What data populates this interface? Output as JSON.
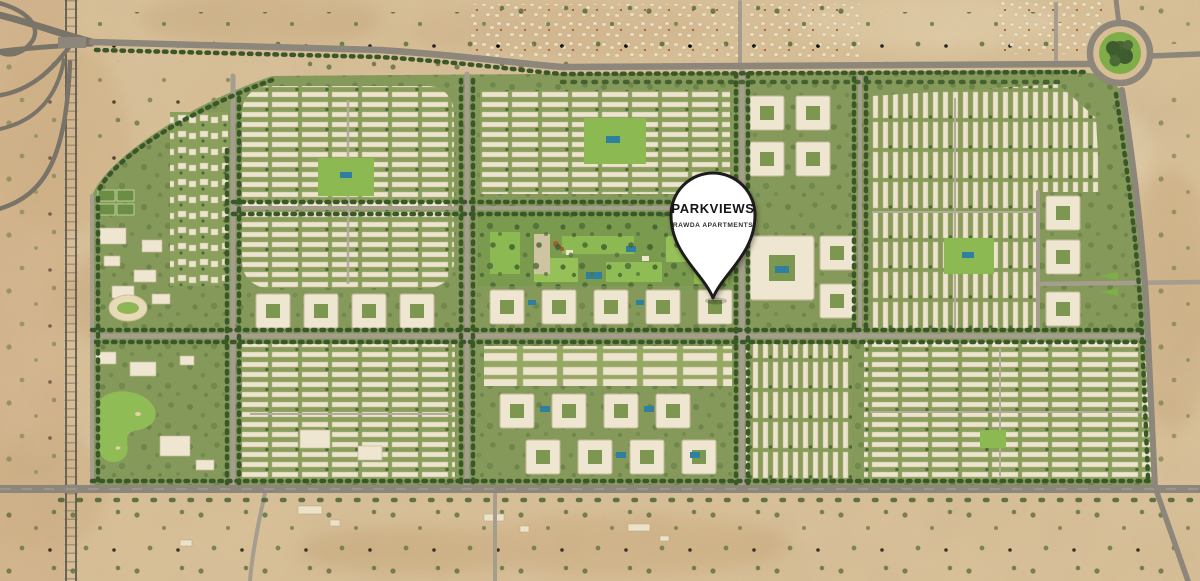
{
  "pin": {
    "title": "PARKVIEWS",
    "subtitle": "RAWDA APARTMENTS"
  },
  "palette": {
    "desert_sand": "#d8be94",
    "desert_mottle": "#cbab7e",
    "development_green": "#85995a",
    "lawn_green": "#8db952",
    "tree_green": "#3a5729",
    "road_main_gray": "#8d867a",
    "road_minor_gray": "#a59d8e",
    "building_cream": "#eee6d0",
    "pool_blue": "#2f7f9e",
    "pin_fill": "#ffffff",
    "pin_outline": "#1f1f1f"
  },
  "icons": {
    "pin": "location-pin-icon"
  }
}
